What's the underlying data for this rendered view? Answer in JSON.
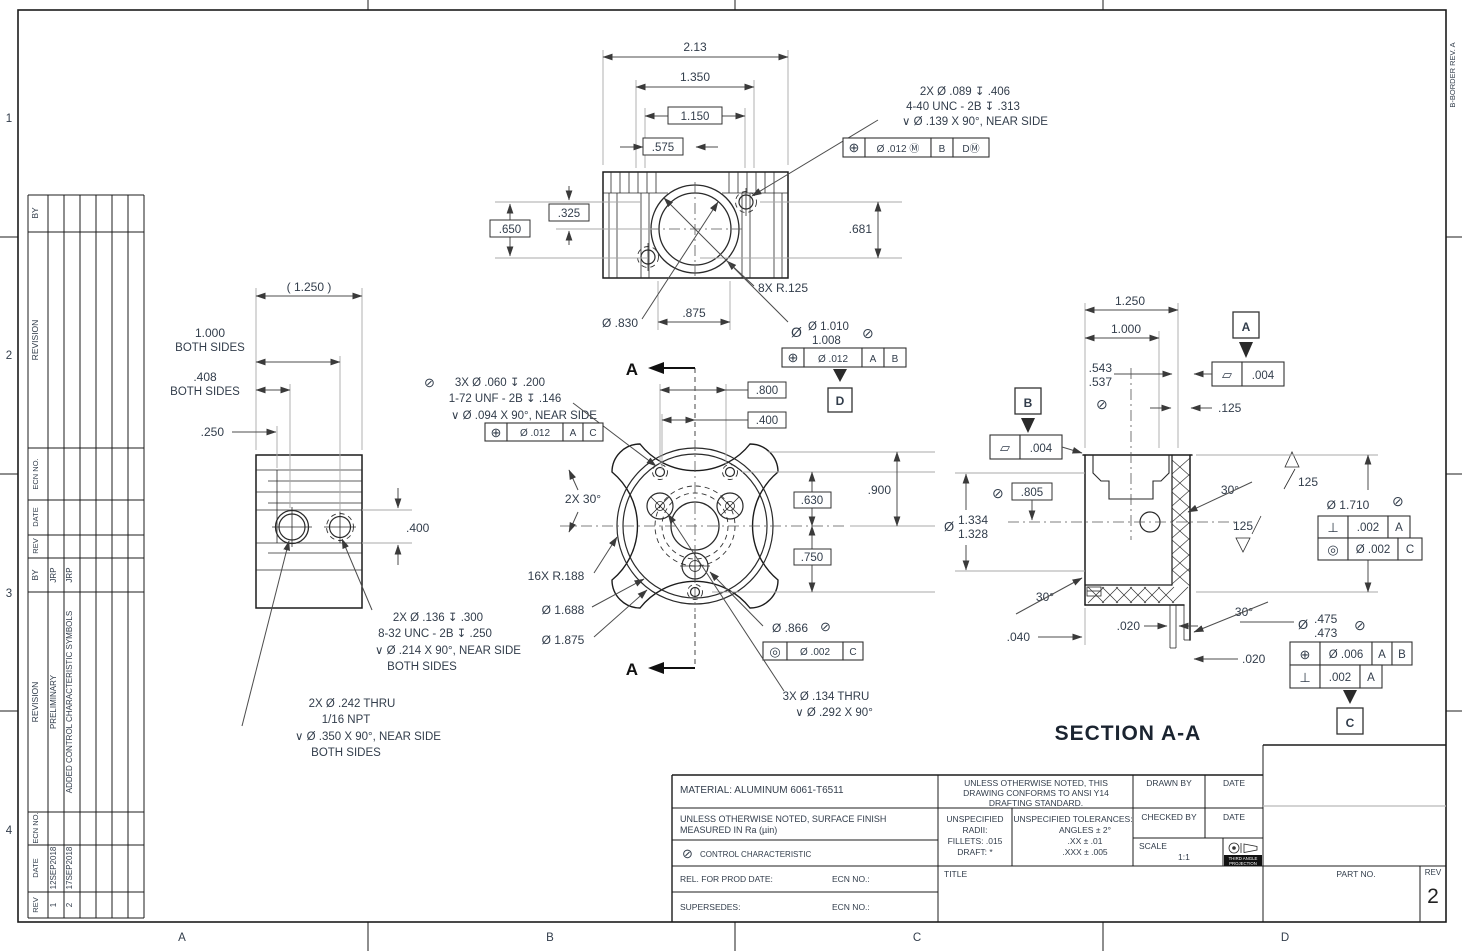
{
  "border": {
    "zone_rows": [
      "1",
      "2",
      "3",
      "4"
    ],
    "zone_cols": [
      "A",
      "B",
      "C",
      "D"
    ],
    "corner_note": "B-BORDER REV. A"
  },
  "rev_table": {
    "h_by": "BY",
    "h_revision": "REVISION",
    "h_ecn": "ECN NO.",
    "h_date": "DATE",
    "h_rev": "REV",
    "entries": [
      {
        "by": "JRP",
        "desc": "PRELIMINARY",
        "date": "12SEP2018",
        "rev": "1"
      },
      {
        "by": "JRP",
        "desc": "ADDED CONTROL CHARACTERISTIC SYMBOLS",
        "date": "17SEP2018",
        "rev": "2"
      }
    ]
  },
  "top_view": {
    "w": "2.13",
    "d1350": "1.350",
    "d1150": "1.150",
    "d575": ".575",
    "d650": ".650",
    "d325": ".325",
    "d681": ".681",
    "bore": "Ø .830",
    "d875": ".875",
    "lobes": "8X R.125",
    "note": [
      "2X  Ø .089  ↧  .406",
      "4-40 UNC - 2B  ↧  .313",
      "∨   Ø .139 X 90°, NEAR SIDE"
    ],
    "fcf": [
      "⊕",
      "Ø .012 Ⓜ",
      "B",
      "DⓂ"
    ],
    "bore_dia_upper": "Ø 1.010",
    "bore_dia_lower": "1.008",
    "flag": "⊘",
    "bore_fcf": [
      "⊕",
      "Ø .012",
      "A",
      "B"
    ],
    "datum_d": "D"
  },
  "side_view": {
    "ref": "( 1.250 )",
    "d1000": "1.000",
    "both": "BOTH SIDES",
    "d408": ".408",
    "d250": ".250",
    "d400": ".400",
    "note1": [
      "2X  Ø .136  ↧  .300",
      "8-32 UNC - 2B  ↧  .250",
      "∨   Ø .214 X 90°, NEAR SIDE",
      "BOTH SIDES"
    ],
    "note2": [
      "2X  Ø .242 THRU",
      "1/16 NPT",
      "∨   Ø .350 X 90°, NEAR SIDE",
      "BOTH SIDES"
    ]
  },
  "front_view": {
    "sec": "A",
    "flag": "⊘",
    "note": [
      "3X  Ø .060  ↧  .200",
      "1-72 UNF - 2B  ↧  .146",
      "∨   Ø .094 X 90°, NEAR SIDE"
    ],
    "fcf": [
      "⊕",
      "Ø .012",
      "A",
      "C"
    ],
    "d800": ".800",
    "d400": ".400",
    "d630": ".630",
    "d900": ".900",
    "d750": ".750",
    "ang": "2X 30°",
    "scallops": "16X R.188",
    "d1688": "Ø 1.688",
    "d1875": "Ø 1.875",
    "d866": "Ø .866",
    "fcf866": [
      "◎",
      "Ø .002",
      "C"
    ],
    "note2": [
      "3X  Ø .134 THRU",
      "∨   Ø .292 X 90°"
    ]
  },
  "section_view": {
    "title": "SECTION A-A",
    "d1250": "1.250",
    "d1000": "1.000",
    "d543": ".543",
    "d537": ".537",
    "flag": "⊘",
    "d125": ".125",
    "datum_a": "A",
    "datum_b": "B",
    "datum_c": "C",
    "fcf_flat": [
      "▱",
      ".004"
    ],
    "d805": ".805",
    "dia_sym": "Ø",
    "d1334": "1.334",
    "d1328": "1.328",
    "ang30": "30°",
    "d040": ".040",
    "d020": ".020",
    "finish": "125",
    "d1710": "Ø 1.710",
    "fcf_perp": [
      "⊥",
      ".002",
      "A"
    ],
    "fcf_conc": [
      "◎",
      "Ø .002",
      "C"
    ],
    "d475": ".475",
    "d473": ".473",
    "fcf_pos": [
      "⊕",
      "Ø .006",
      "A",
      "B"
    ]
  },
  "title_block": {
    "material": "MATERIAL: ALUMINUM 6061-T6511",
    "finish_note1": "UNLESS OTHERWISE NOTED, SURFACE FINISH",
    "finish_note2": "MEASURED IN Ra (µin)",
    "control_sym": "⊘",
    "control": "CONTROL CHARACTERISTIC",
    "rel": "REL. FOR PROD DATE:",
    "ecn": "ECN NO.:",
    "supersedes": "SUPERSEDES:",
    "conform": [
      "UNLESS OTHERWISE NOTED, THIS",
      "DRAWING CONFORMS TO ANSI Y14",
      "DRAFTING STANDARD."
    ],
    "radii": [
      "UNSPECIFIED",
      "RADII:",
      "FILLETS: .015",
      "DRAFT:  *"
    ],
    "tol": [
      "UNSPECIFIED TOLERANCES:",
      "ANGLES ± 2°",
      ".XX ± .01",
      ".XXX ± .005"
    ],
    "drawn_by": "DRAWN BY",
    "date": "DATE",
    "checked_by": "CHECKED BY",
    "scale": "SCALE",
    "scale_val": "1:1",
    "proj1": "THIRD ANGLE",
    "proj2": "PROJECTION",
    "title": "TITLE",
    "part_no": "PART NO.",
    "rev": "REV",
    "rev_val": "2"
  }
}
